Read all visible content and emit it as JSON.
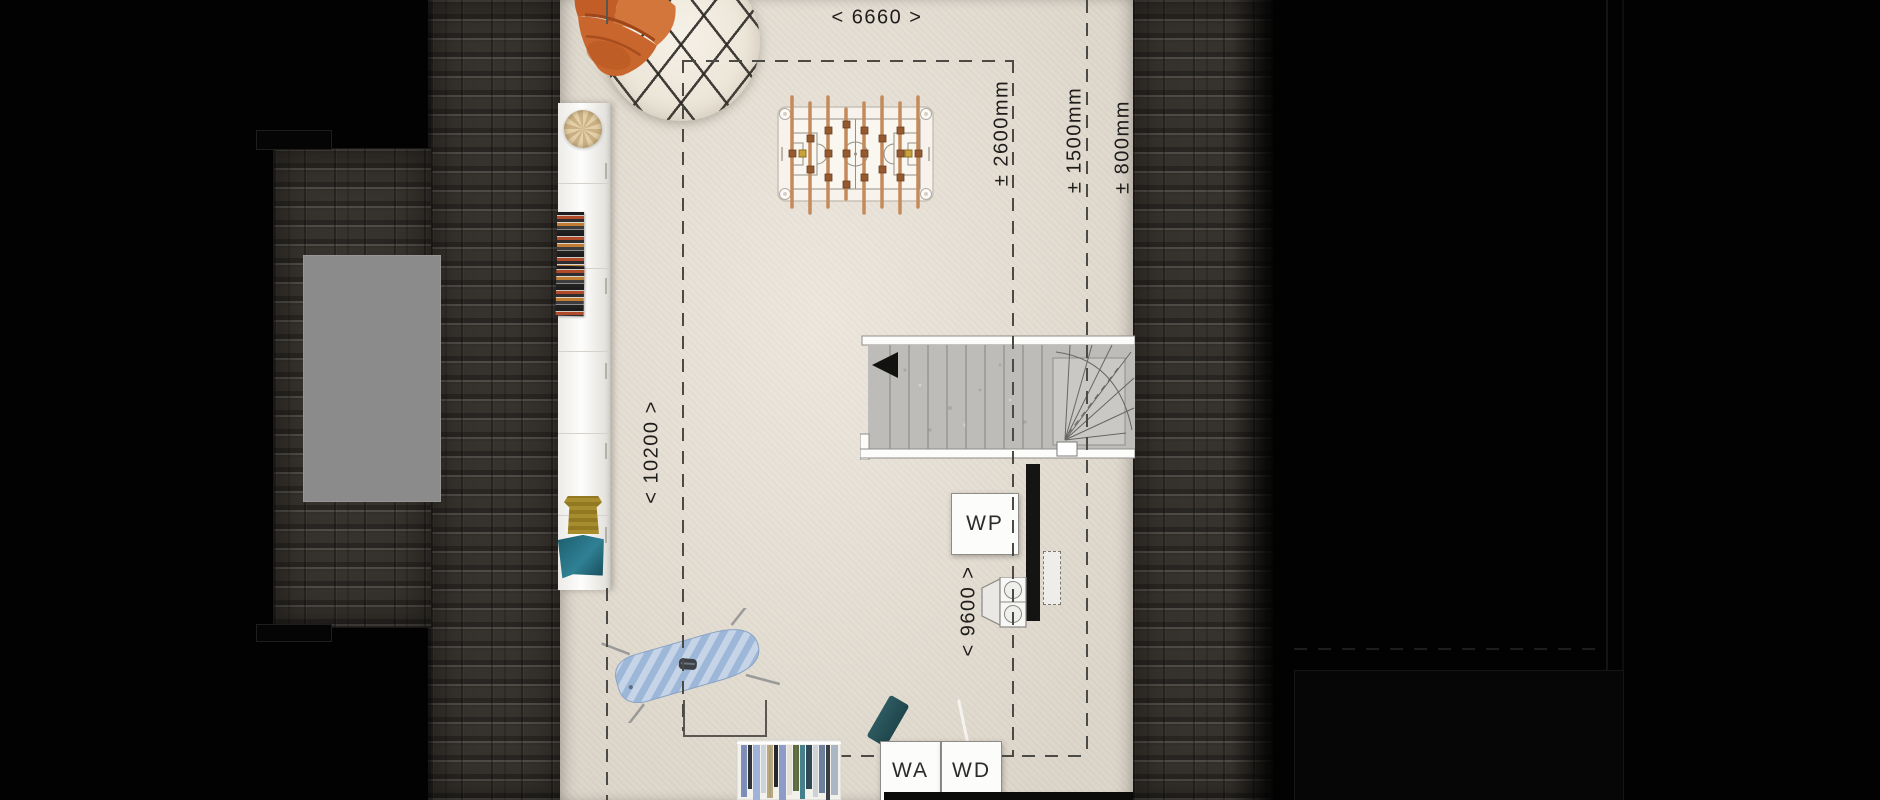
{
  "plan": {
    "description": "attic floor plan, top-down view",
    "dimension_labels": {
      "width_top": "< 6660 >",
      "depth_left": "< 10200 >",
      "depth_inner": "< 9600 >",
      "clearance_2600": "± 2600mm",
      "clearance_1500": "± 1500mm",
      "clearance_800": "± 800mm"
    },
    "appliance_labels": {
      "heat_pump": "WP",
      "washing_machine": "WA",
      "dryer": "WD"
    },
    "colors": {
      "background": "#000000",
      "roof_tiles": "#36322d",
      "skylight": "#8b8b8b",
      "floor": "#e8e1d5",
      "dimension_lines": "#4c4a45",
      "chair_leather": "#c9622b",
      "ironing_board": "#9db7d9",
      "stair_treads": "#bdbcb9"
    }
  }
}
